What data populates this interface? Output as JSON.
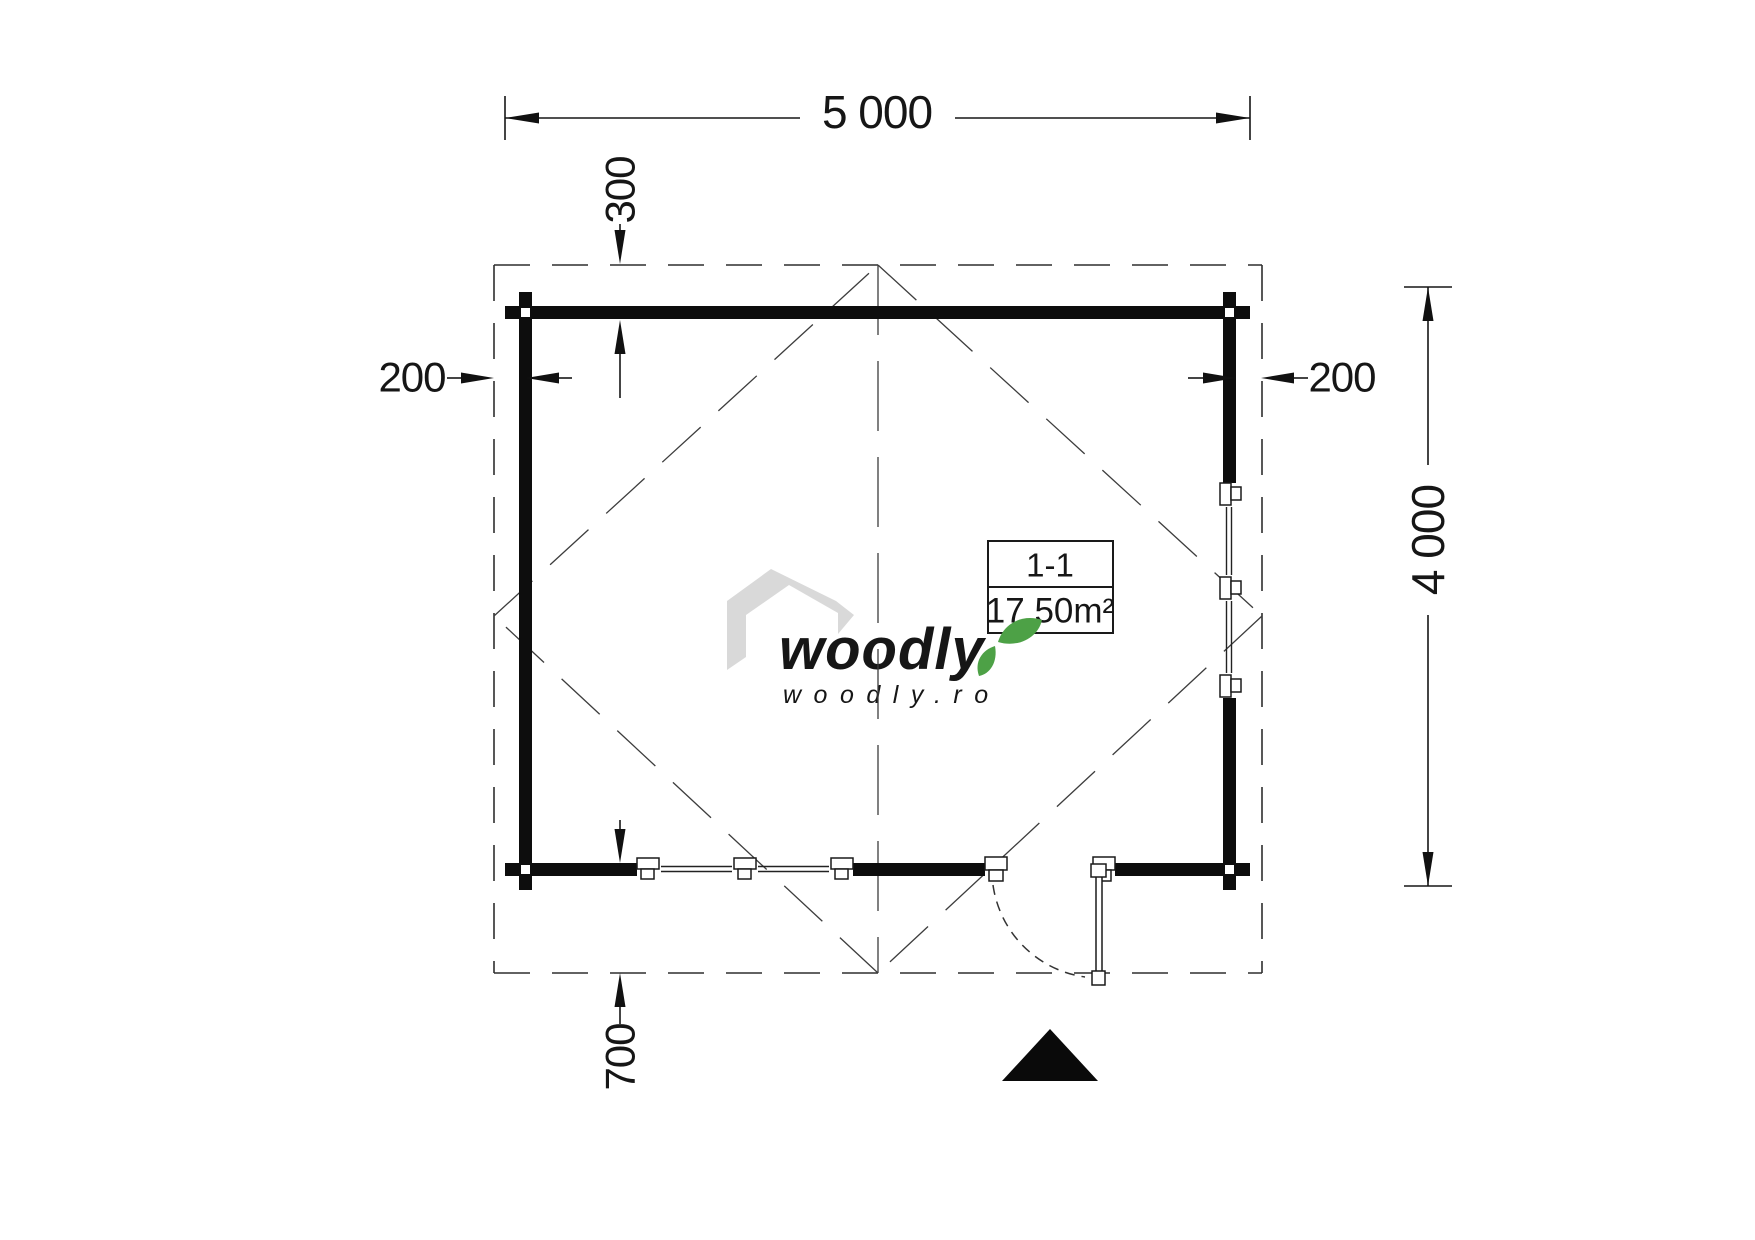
{
  "plan": {
    "dims": {
      "width": "5 000",
      "height": "4 000",
      "top_offset": "300",
      "left_offset": "200",
      "right_offset": "200",
      "bottom_offset": "700"
    },
    "room": {
      "section": "1-1",
      "area": "17.50m²"
    },
    "logo": {
      "brand": "woodly",
      "site": "woodly.ro"
    },
    "icons": {
      "entrance_marker": "filled-triangle",
      "roof_overhang": "dashed-rectangle",
      "roof_slopes": "dashed-diamond-with-ridge",
      "door": "outward-swing-door",
      "windows": "double-casement-window"
    },
    "colors": {
      "line": "#161616",
      "wall": "#0d0d0d",
      "roof_dash": "#3d3d3d",
      "overhang_dash": "#2e2e2e",
      "logo_gray": "#d9d9d9",
      "url_gray": "#c8c8c8",
      "leaf_green": "#4da146",
      "background": "#ffffff"
    }
  }
}
